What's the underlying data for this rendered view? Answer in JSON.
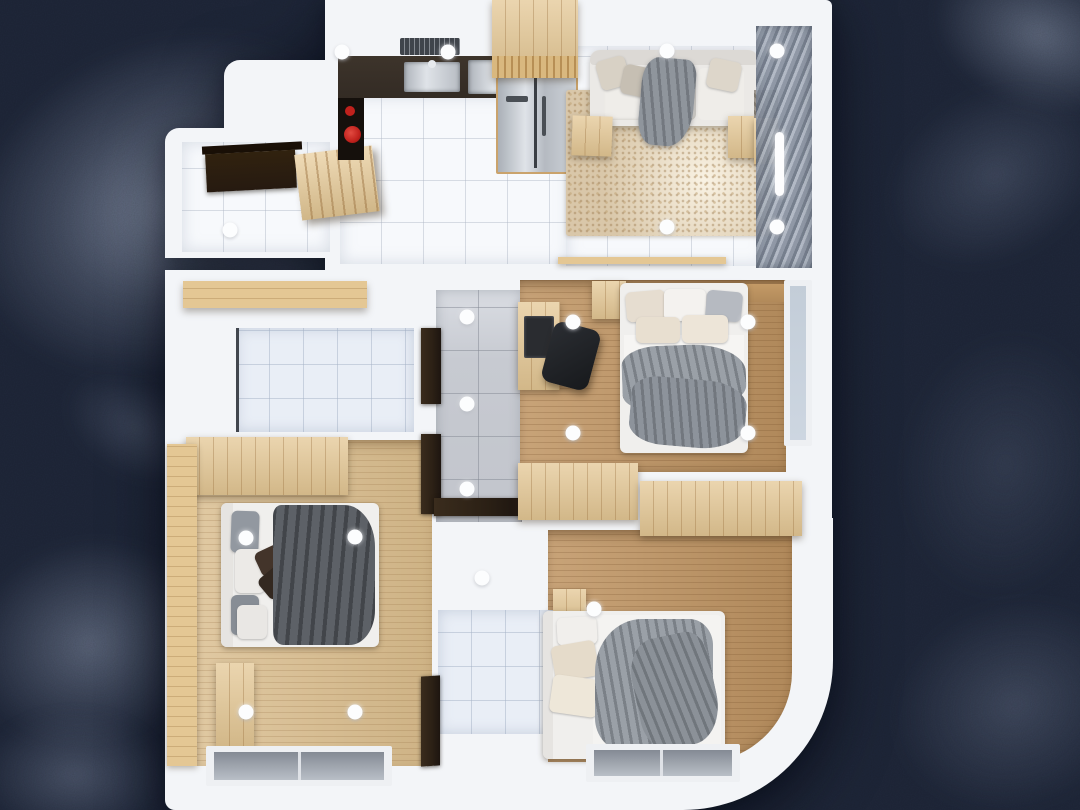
{
  "scene": {
    "kind": "3d-apartment-floor-plan-top-down-render",
    "background_style": "dark navy abstract painted texture",
    "canvas": {
      "width": 1080,
      "height": 810
    }
  },
  "palette": {
    "bgBase": "#1b2232",
    "bgStroke": "#8d97ab",
    "wall": "#f3f5f8",
    "tileWhite": "#f7f9fc",
    "tileBlue": "#e9eef6",
    "tileGrey": "#c7cad1",
    "woodMid": "#bf9462",
    "woodLight": "#d9bc8c",
    "woodCabinet": "#e4c794",
    "headboard": "#b28a5a",
    "counter": "#332b24",
    "doorDark": "#2b2015",
    "sofa": "#ebe9e6",
    "rug": "#d9c7a9",
    "fabricGrey": "#9aa0a7",
    "fabricDark": "#5d6167",
    "brownPillow": "#3f3129",
    "accentRed": "#c0211c",
    "glass": "#cdd6e1",
    "curtainA": "#6f7887",
    "curtainB": "#aeb6c2",
    "curtainC": "#8a93a1"
  },
  "rooms": [
    {
      "id": "entry-hall",
      "floor": "white-tile"
    },
    {
      "id": "kitchen",
      "floor": "white-tile"
    },
    {
      "id": "living-room",
      "floor": "white-tile-with-rug"
    },
    {
      "id": "balcony",
      "floor": "behind-louver-curtain"
    },
    {
      "id": "bathroom-left",
      "floor": "pale-blue-tile"
    },
    {
      "id": "hallway",
      "floor": "grey-tile"
    },
    {
      "id": "master-bedroom",
      "floor": "oak-wood"
    },
    {
      "id": "bedroom-left",
      "floor": "light-oak-wood"
    },
    {
      "id": "bathroom-bottom",
      "floor": "pale-tile"
    },
    {
      "id": "bedroom-right",
      "floor": "oak-wood-rounded-corner"
    }
  ],
  "ceiling_lights": [
    [
      342,
      52
    ],
    [
      448,
      52
    ],
    [
      667,
      51
    ],
    [
      777,
      51
    ],
    [
      667,
      227
    ],
    [
      777,
      227
    ],
    [
      230,
      230
    ],
    [
      467,
      317
    ],
    [
      467,
      404
    ],
    [
      467,
      489
    ],
    [
      573,
      322
    ],
    [
      748,
      322
    ],
    [
      573,
      433
    ],
    [
      748,
      433
    ],
    [
      246,
      538
    ],
    [
      355,
      537
    ],
    [
      246,
      712
    ],
    [
      355,
      712
    ],
    [
      482,
      578
    ],
    [
      594,
      609
    ]
  ],
  "wall_light_bar": {
    "x": 779,
    "y": 164
  },
  "accents": {
    "kettle": "red",
    "fridge": "stainless-double-door"
  }
}
